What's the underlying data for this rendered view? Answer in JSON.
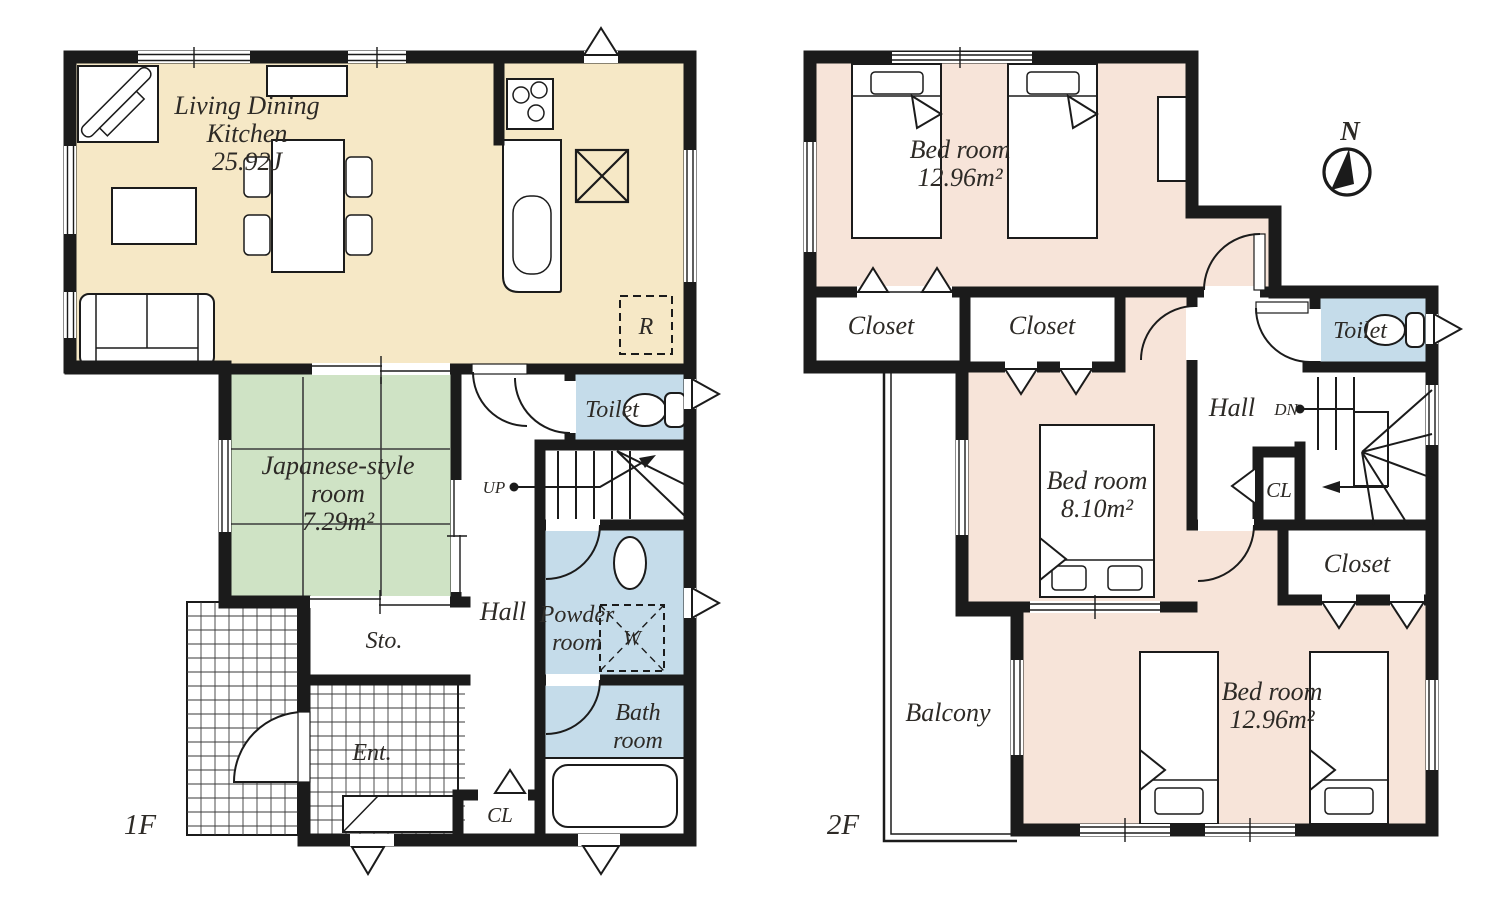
{
  "colors": {
    "wall": "#1b1b1b",
    "ldk": "#F6E8C6",
    "tatami": "#CFE3C5",
    "wet": "#C5DCEA",
    "bedroom": "#F7E4D9"
  },
  "floor1": {
    "floor_label": "1F",
    "ldk_line1": "Living Dining",
    "ldk_line2": "Kitchen",
    "ldk_area": "25.92J",
    "japanese_line1": "Japanese-style",
    "japanese_line2": "room",
    "japanese_area": "7.29m²",
    "hall": "Hall",
    "toilet": "Toilet",
    "up": "UP",
    "powder_line1": "Powder",
    "powder_line2": "room",
    "washer": "W",
    "bath_line1": "Bath",
    "bath_line2": "room",
    "storage": "Sto.",
    "entrance": "Ent.",
    "closet": "CL",
    "fridge": "R"
  },
  "floor2": {
    "floor_label": "2F",
    "bedroom1_label": "Bed room",
    "bedroom1_area": "12.96m²",
    "bedroom2_label": "Bed room",
    "bedroom2_area": "8.10m²",
    "bedroom3_label": "Bed room",
    "bedroom3_area": "12.96m²",
    "closet_a": "Closet",
    "closet_b": "Closet",
    "closet_c": "Closet",
    "toilet": "Toilet",
    "hall": "Hall",
    "down": "DN",
    "cl": "CL",
    "balcony": "Balcony",
    "compass": "N"
  }
}
